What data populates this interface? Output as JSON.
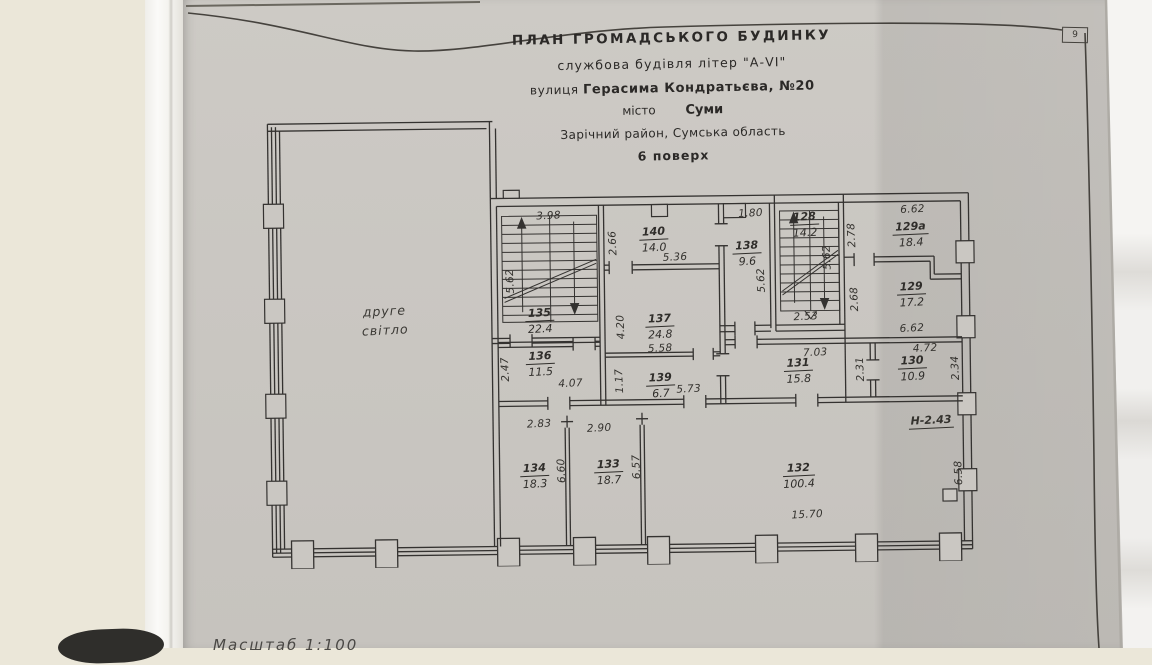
{
  "page": {
    "number": "9",
    "scale_note": "Масштаб  1:100"
  },
  "title_block": {
    "line1": "ПЛАН  ГРОМАДСЬКОГО  БУДИНКУ",
    "line2": "службова будівля літер \"А-VI\"",
    "line3_label": "вулиця",
    "line3_value": "Герасима Кондратьєва, №20",
    "line4_label": "місто",
    "line4_value": "Суми",
    "line5": "Зарічний район, Сумська область",
    "line6": "6 поверх"
  },
  "plan": {
    "void_label": "друге\nсвітло",
    "height_note": "Н-2.43",
    "rooms": [
      {
        "number": "135",
        "area": "22.4",
        "x": 285,
        "y": 215
      },
      {
        "number": "136",
        "area": "11.5",
        "x": 285,
        "y": 258
      },
      {
        "number": "137",
        "area": "24.8",
        "x": 405,
        "y": 222
      },
      {
        "number": "138",
        "area": "9.6",
        "x": 493,
        "y": 150
      },
      {
        "number": "139",
        "area": "6.7",
        "x": 405,
        "y": 281
      },
      {
        "number": "140",
        "area": "14.0",
        "x": 400,
        "y": 135
      },
      {
        "number": "128",
        "area": "14.2",
        "x": 551,
        "y": 122
      },
      {
        "number": "129а",
        "area": "18.4",
        "x": 657,
        "y": 133
      },
      {
        "number": "129",
        "area": "17.2",
        "x": 657,
        "y": 193
      },
      {
        "number": "130",
        "area": "10.9",
        "x": 657,
        "y": 267
      },
      {
        "number": "131",
        "area": "15.8",
        "x": 543,
        "y": 268
      },
      {
        "number": "132",
        "area": "100.4",
        "x": 542,
        "y": 373
      },
      {
        "number": "133",
        "area": "18.7",
        "x": 352,
        "y": 367
      },
      {
        "number": "134",
        "area": "18.3",
        "x": 278,
        "y": 370
      }
    ],
    "dims": [
      {
        "text": "3.98",
        "x": 295,
        "y": 110
      },
      {
        "text": "2.66",
        "x": 359,
        "y": 138,
        "rot": -90
      },
      {
        "text": "5.36",
        "x": 421,
        "y": 153
      },
      {
        "text": "5.62",
        "x": 256,
        "y": 175,
        "rot": -90
      },
      {
        "text": "1.80",
        "x": 497,
        "y": 110
      },
      {
        "text": "5.62",
        "x": 507,
        "y": 177,
        "rot": -90
      },
      {
        "text": "5.62",
        "x": 573,
        "y": 155,
        "rot": -90
      },
      {
        "text": "2.78",
        "x": 598,
        "y": 133,
        "rot": -90
      },
      {
        "text": "6.62",
        "x": 659,
        "y": 108
      },
      {
        "text": "2.53",
        "x": 551,
        "y": 214
      },
      {
        "text": "2.68",
        "x": 600,
        "y": 197,
        "rot": -90
      },
      {
        "text": "6.62",
        "x": 657,
        "y": 227
      },
      {
        "text": "4.20",
        "x": 366,
        "y": 222,
        "rot": -90
      },
      {
        "text": "5.58",
        "x": 405,
        "y": 244
      },
      {
        "text": "1.17",
        "x": 364,
        "y": 276,
        "rot": -90
      },
      {
        "text": "5.73",
        "x": 433,
        "y": 285
      },
      {
        "text": "2.47",
        "x": 250,
        "y": 263,
        "rot": -90
      },
      {
        "text": "4.07",
        "x": 315,
        "y": 278
      },
      {
        "text": "7.03",
        "x": 560,
        "y": 250
      },
      {
        "text": "2.31",
        "x": 605,
        "y": 267,
        "rot": -90
      },
      {
        "text": "4.72",
        "x": 670,
        "y": 247
      },
      {
        "text": "2.34",
        "x": 700,
        "y": 267,
        "rot": -90
      },
      {
        "text": "2.83",
        "x": 283,
        "y": 318
      },
      {
        "text": "2.90",
        "x": 343,
        "y": 323
      },
      {
        "text": "6.60",
        "x": 305,
        "y": 365,
        "rot": -90
      },
      {
        "text": "6.57",
        "x": 380,
        "y": 362,
        "rot": -90
      },
      {
        "text": "15.70",
        "x": 550,
        "y": 412
      },
      {
        "text": "6.58",
        "x": 702,
        "y": 372,
        "rot": -90
      }
    ]
  }
}
